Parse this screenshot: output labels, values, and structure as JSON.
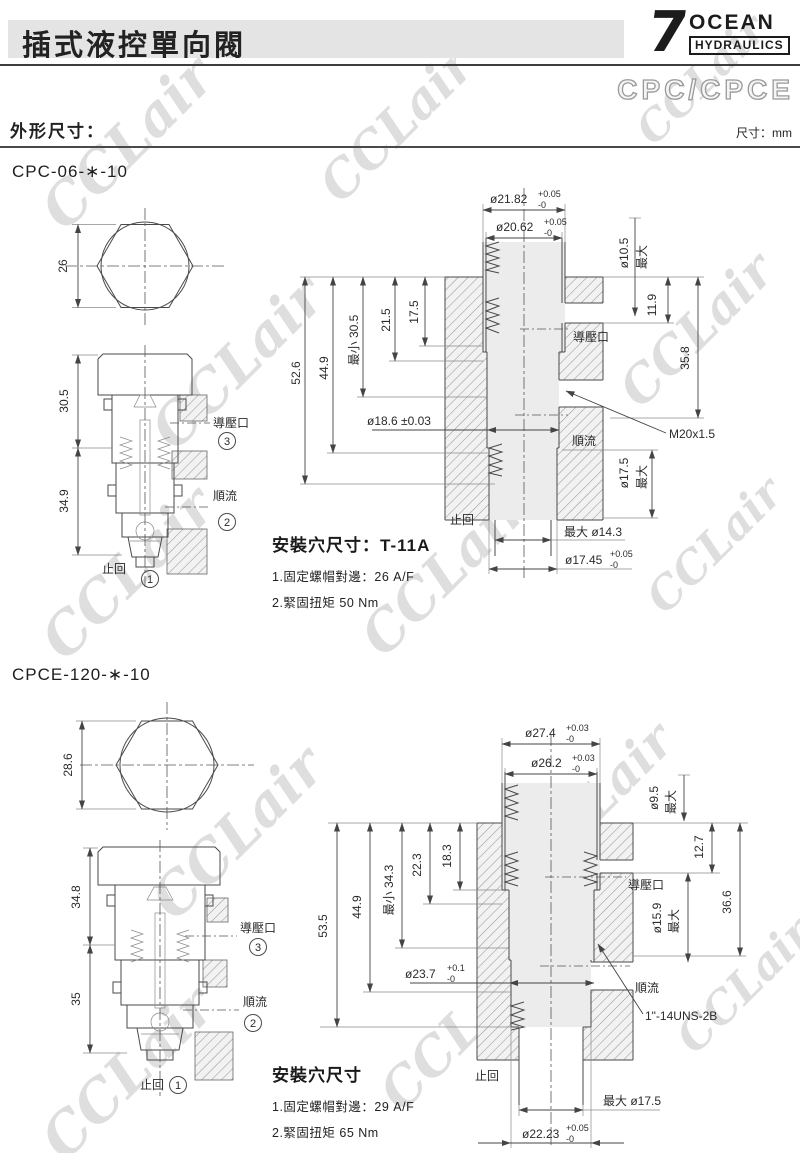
{
  "header": {
    "title": "插式液控單向閥",
    "logo": {
      "numeral": "7",
      "brand": "OCEAN",
      "sub": "HYDRAULICS"
    },
    "series": "CPC/CPCE",
    "section_label": "外形尺寸：",
    "unit_note": "尺寸：mm"
  },
  "watermark": {
    "text": "CCLair"
  },
  "cpc": {
    "model": "CPC-06-∗-10",
    "hex_af": "26",
    "sec_dim_upper": "30.5",
    "sec_dim_lower": "34.9",
    "port_pilot": "導壓口",
    "port_pilot_no": "3",
    "port_flow": "順流",
    "port_flow_no": "2",
    "port_check": "止回",
    "port_check_no": "1",
    "cav": {
      "dia_top1": "ø21.82",
      "dia_top1_tp": "+0.05",
      "dia_top1_tm": "-0",
      "dia_top2": "ø20.62",
      "dia_top2_tp": "+0.05",
      "dia_top2_tm": "-0",
      "pilot_dia": "ø10.5",
      "pilot_dia_max": "最大",
      "pilot_depth": "11.9",
      "right_depth": "35.8",
      "d_total": "52.6",
      "d_449": "44.9",
      "d_min": "最小 30.5",
      "d_215": "21.5",
      "d_175": "17.5",
      "bore": "ø18.6 ±0.03",
      "thread": "M20x1.5",
      "pilot_label": "導壓口",
      "flow_label": "順流",
      "check_label": "止回",
      "low_dia": "ø17.5",
      "low_dia_max": "最大",
      "nose_dia": "最大 ø14.3",
      "bot_dia": "ø17.45",
      "bot_tp": "+0.05",
      "bot_tm": "-0"
    },
    "install": {
      "title": "安裝穴尺寸：T-11A",
      "note1": "1.固定螺帽對邊：26 A/F",
      "note2": "2.緊固扭矩 50 Nm"
    }
  },
  "cpce": {
    "model": "CPCE-120-∗-10",
    "hex_af": "28.6",
    "sec_dim_upper": "34.8",
    "sec_dim_lower": "35",
    "port_pilot": "導壓口",
    "port_pilot_no": "3",
    "port_flow": "順流",
    "port_flow_no": "2",
    "port_check": "止回",
    "port_check_no": "1",
    "cav": {
      "dia_top1": "ø27.4",
      "dia_top1_tp": "+0.03",
      "dia_top1_tm": "-0",
      "dia_top2": "ø26.2",
      "dia_top2_tp": "+0.03",
      "dia_top2_tm": "-0",
      "pilot_dia": "ø9.5",
      "pilot_dia_max": "最大",
      "pilot_depth": "12.7",
      "right_depth": "36.6",
      "d_total": "53.5",
      "d_449": "44.9",
      "d_min": "最小 34.3",
      "d_223": "22.3",
      "d_183": "18.3",
      "mid_dia": "ø15.9",
      "mid_dia_max": "最大",
      "bore": "ø23.7",
      "bore_tp": "+0.1",
      "bore_tm": "-0",
      "thread": "1\"-14UNS-2B",
      "pilot_label": "導壓口",
      "flow_label": "順流",
      "check_label": "止回",
      "nose_dia": "最大 ø17.5",
      "bot_dia": "ø22.23",
      "bot_tp": "+0.05",
      "bot_tm": "-0"
    },
    "install": {
      "title": "安裝穴尺寸",
      "note1": "1.固定螺帽對邊：29 A/F",
      "note2": "2.緊固扭矩 65 Nm"
    }
  }
}
